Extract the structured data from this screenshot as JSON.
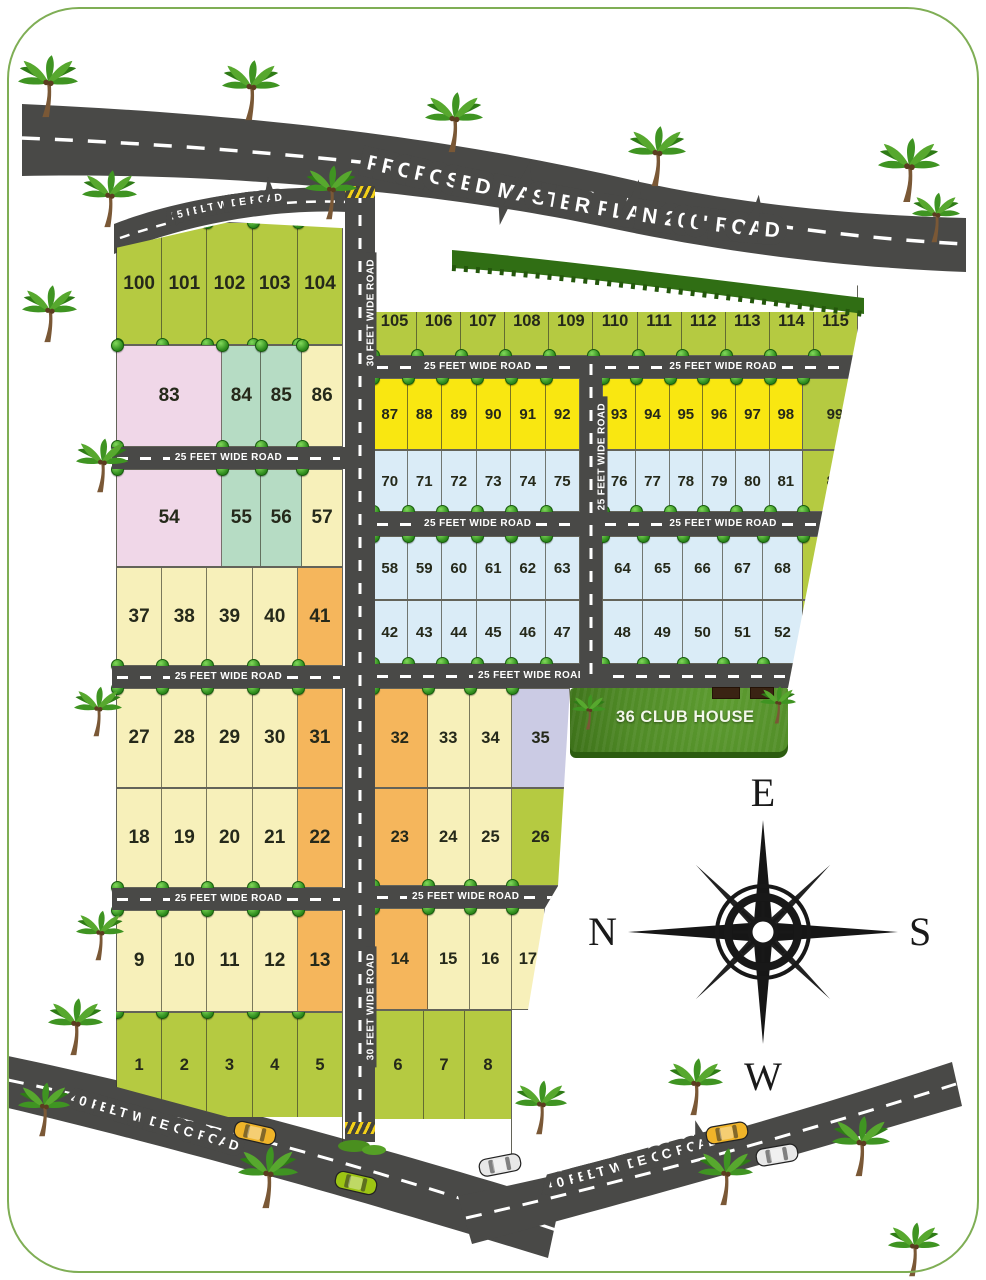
{
  "roads": {
    "master": "PROPOSED MASTER PLAN 200' ROAD",
    "w25": "25 FEET WIDE ROAD",
    "w30": "30 FEET WIDE ROAD",
    "cc40": "40 FEET WIDE CC ROAD"
  },
  "club_house": "36 CLUB HOUSE",
  "compass": {
    "top": "E",
    "left": "N",
    "right": "S",
    "bottom": "W"
  },
  "colors": {
    "road": "#494947",
    "plot_green": "#b5ca41",
    "plot_cream": "#f7f0ba",
    "plot_yellow": "#f9e711",
    "plot_blue": "#daecf7",
    "plot_pink": "#f0d7e8",
    "plot_teal": "#b6dcc4",
    "plot_orange": "#f5b65c",
    "plot_lavender": "#cbcbe4",
    "club_grass": "#4f8a26",
    "frame_border": "#7fae55"
  },
  "rows": {
    "L100": [
      {
        "n": "100",
        "c": "green"
      },
      {
        "n": "101",
        "c": "green"
      },
      {
        "n": "102",
        "c": "green"
      },
      {
        "n": "103",
        "c": "green"
      },
      {
        "n": "104",
        "c": "green"
      }
    ],
    "L83": [
      {
        "n": "83",
        "c": "pink",
        "w": 2.75
      },
      {
        "n": "84",
        "c": "teal"
      },
      {
        "n": "85",
        "c": "teal",
        "w": 1.05
      },
      {
        "n": "86",
        "c": "cream",
        "w": 1.05
      }
    ],
    "L54": [
      {
        "n": "54",
        "c": "pink",
        "w": 2.75
      },
      {
        "n": "55",
        "c": "teal"
      },
      {
        "n": "56",
        "c": "teal",
        "w": 1.05
      },
      {
        "n": "57",
        "c": "cream",
        "w": 1.05
      }
    ],
    "L37": [
      {
        "n": "37",
        "c": "cream"
      },
      {
        "n": "38",
        "c": "cream"
      },
      {
        "n": "39",
        "c": "cream"
      },
      {
        "n": "40",
        "c": "cream"
      },
      {
        "n": "41",
        "c": "orange"
      }
    ],
    "L27": [
      {
        "n": "27",
        "c": "cream"
      },
      {
        "n": "28",
        "c": "cream"
      },
      {
        "n": "29",
        "c": "cream"
      },
      {
        "n": "30",
        "c": "cream"
      },
      {
        "n": "31",
        "c": "orange"
      }
    ],
    "L18": [
      {
        "n": "18",
        "c": "cream"
      },
      {
        "n": "19",
        "c": "cream"
      },
      {
        "n": "20",
        "c": "cream"
      },
      {
        "n": "21",
        "c": "cream"
      },
      {
        "n": "22",
        "c": "orange"
      }
    ],
    "L9": [
      {
        "n": "9",
        "c": "cream"
      },
      {
        "n": "10",
        "c": "cream"
      },
      {
        "n": "11",
        "c": "cream"
      },
      {
        "n": "12",
        "c": "cream"
      },
      {
        "n": "13",
        "c": "orange"
      }
    ],
    "L1": [
      {
        "n": "1",
        "c": "green"
      },
      {
        "n": "2",
        "c": "green"
      },
      {
        "n": "3",
        "c": "green"
      },
      {
        "n": "4",
        "c": "green"
      },
      {
        "n": "5",
        "c": "green"
      }
    ],
    "R105": [
      {
        "n": "105",
        "c": "green"
      },
      {
        "n": "106",
        "c": "green"
      },
      {
        "n": "107",
        "c": "green"
      },
      {
        "n": "108",
        "c": "green"
      },
      {
        "n": "109",
        "c": "green"
      },
      {
        "n": "110",
        "c": "green"
      },
      {
        "n": "111",
        "c": "green"
      },
      {
        "n": "112",
        "c": "green"
      },
      {
        "n": "113",
        "c": "green"
      },
      {
        "n": "114",
        "c": "green"
      },
      {
        "n": "115",
        "c": "green"
      }
    ],
    "R87": [
      {
        "n": "87",
        "c": "yellow"
      },
      {
        "n": "88",
        "c": "yellow"
      },
      {
        "n": "89",
        "c": "yellow"
      },
      {
        "n": "90",
        "c": "yellow"
      },
      {
        "n": "91",
        "c": "yellow"
      },
      {
        "n": "92",
        "c": "yellow"
      }
    ],
    "R93": [
      {
        "n": "93",
        "c": "yellow"
      },
      {
        "n": "94",
        "c": "yellow"
      },
      {
        "n": "95",
        "c": "yellow"
      },
      {
        "n": "96",
        "c": "yellow"
      },
      {
        "n": "97",
        "c": "yellow"
      },
      {
        "n": "98",
        "c": "yellow"
      }
    ],
    "R99": [
      {
        "n": "99",
        "c": "green"
      }
    ],
    "R70": [
      {
        "n": "70",
        "c": "blue"
      },
      {
        "n": "71",
        "c": "blue"
      },
      {
        "n": "72",
        "c": "blue"
      },
      {
        "n": "73",
        "c": "blue"
      },
      {
        "n": "74",
        "c": "blue"
      },
      {
        "n": "75",
        "c": "blue"
      }
    ],
    "R76": [
      {
        "n": "76",
        "c": "blue"
      },
      {
        "n": "77",
        "c": "blue"
      },
      {
        "n": "78",
        "c": "blue"
      },
      {
        "n": "79",
        "c": "blue"
      },
      {
        "n": "80",
        "c": "blue"
      },
      {
        "n": "81",
        "c": "blue"
      }
    ],
    "R82": [
      {
        "n": "82",
        "c": "green"
      }
    ],
    "R58": [
      {
        "n": "58",
        "c": "blue"
      },
      {
        "n": "59",
        "c": "blue"
      },
      {
        "n": "60",
        "c": "blue"
      },
      {
        "n": "61",
        "c": "blue"
      },
      {
        "n": "62",
        "c": "blue"
      },
      {
        "n": "63",
        "c": "blue"
      }
    ],
    "R64": [
      {
        "n": "64",
        "c": "blue"
      },
      {
        "n": "65",
        "c": "blue"
      },
      {
        "n": "66",
        "c": "blue"
      },
      {
        "n": "67",
        "c": "blue"
      },
      {
        "n": "68",
        "c": "blue"
      }
    ],
    "R69": [
      {
        "n": "69",
        "c": "green"
      }
    ],
    "R42": [
      {
        "n": "42",
        "c": "blue"
      },
      {
        "n": "43",
        "c": "blue"
      },
      {
        "n": "44",
        "c": "blue"
      },
      {
        "n": "45",
        "c": "blue"
      },
      {
        "n": "46",
        "c": "blue"
      },
      {
        "n": "47",
        "c": "blue"
      }
    ],
    "R48": [
      {
        "n": "48",
        "c": "blue"
      },
      {
        "n": "49",
        "c": "blue"
      },
      {
        "n": "50",
        "c": "blue"
      },
      {
        "n": "51",
        "c": "blue"
      },
      {
        "n": "52",
        "c": "blue"
      }
    ],
    "R53": [
      {
        "n": "53",
        "c": "green"
      }
    ],
    "R32": [
      {
        "n": "32",
        "c": "orange",
        "w": 1.3
      },
      {
        "n": "33",
        "c": "cream"
      },
      {
        "n": "34",
        "c": "cream"
      },
      {
        "n": "35",
        "c": "lavender",
        "w": 1.38
      }
    ],
    "R23": [
      {
        "n": "23",
        "c": "orange",
        "w": 1.3
      },
      {
        "n": "24",
        "c": "cream"
      },
      {
        "n": "25",
        "c": "cream"
      },
      {
        "n": "26",
        "c": "green",
        "w": 1.38
      }
    ],
    "R14": [
      {
        "n": "14",
        "c": "orange",
        "w": 1.3
      },
      {
        "n": "15",
        "c": "cream"
      },
      {
        "n": "16",
        "c": "cream"
      },
      {
        "n": "17",
        "c": "cream",
        "w": 0.78
      }
    ],
    "R6": [
      {
        "n": "6",
        "c": "green",
        "w": 1.25
      },
      {
        "n": "7",
        "c": "green"
      },
      {
        "n": "8",
        "c": "green",
        "w": 1.15
      }
    ]
  }
}
